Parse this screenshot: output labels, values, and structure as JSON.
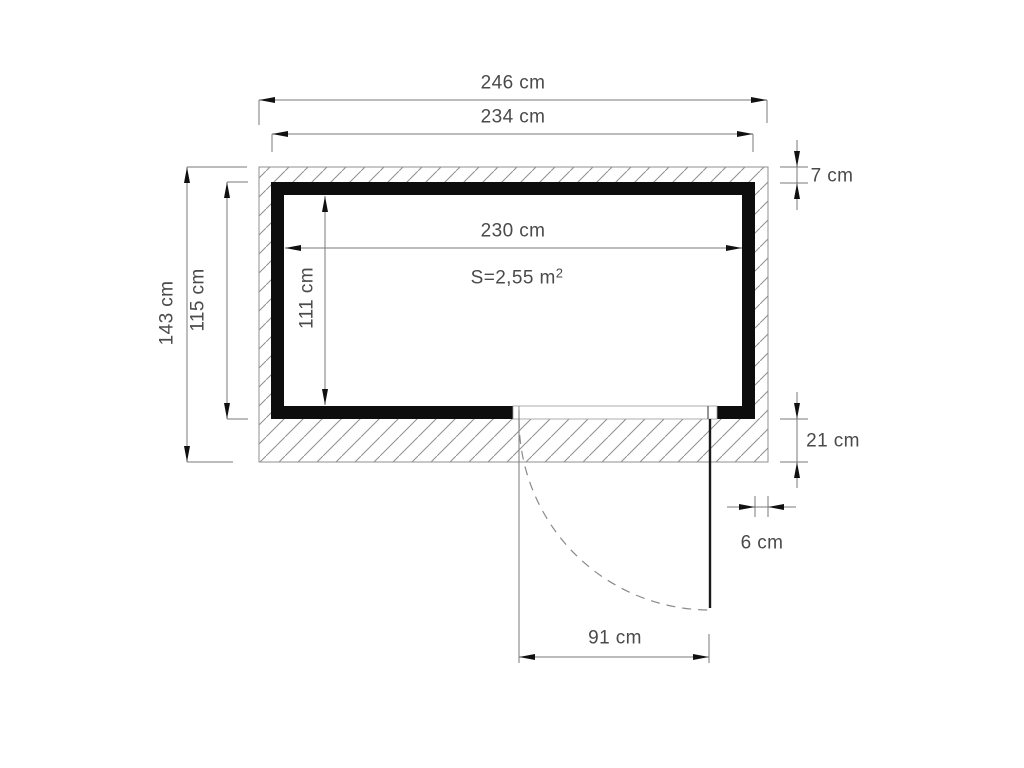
{
  "dimensions": {
    "outer_width": "246 cm",
    "wall_outer_width": "234 cm",
    "interior_width": "230 cm",
    "outer_depth": "143 cm",
    "wall_outer_depth": "115 cm",
    "interior_depth": "111 cm",
    "top_wall_thickness": "7 cm",
    "bottom_wall_thickness": "21 cm",
    "side_wall_thickness": "6 cm",
    "door_width": "91 cm"
  },
  "area": {
    "text": "S=2,55 m",
    "exponent": "2"
  },
  "colors": {
    "background": "#ffffff",
    "wall_fill": "#0d0d0d",
    "hatch_line": "#8f8f8f",
    "dimension_line": "#7a7a7a",
    "arrow_fill": "#111111",
    "label_text": "#4a4a4a",
    "door_leaf": "#1a1a1a"
  }
}
